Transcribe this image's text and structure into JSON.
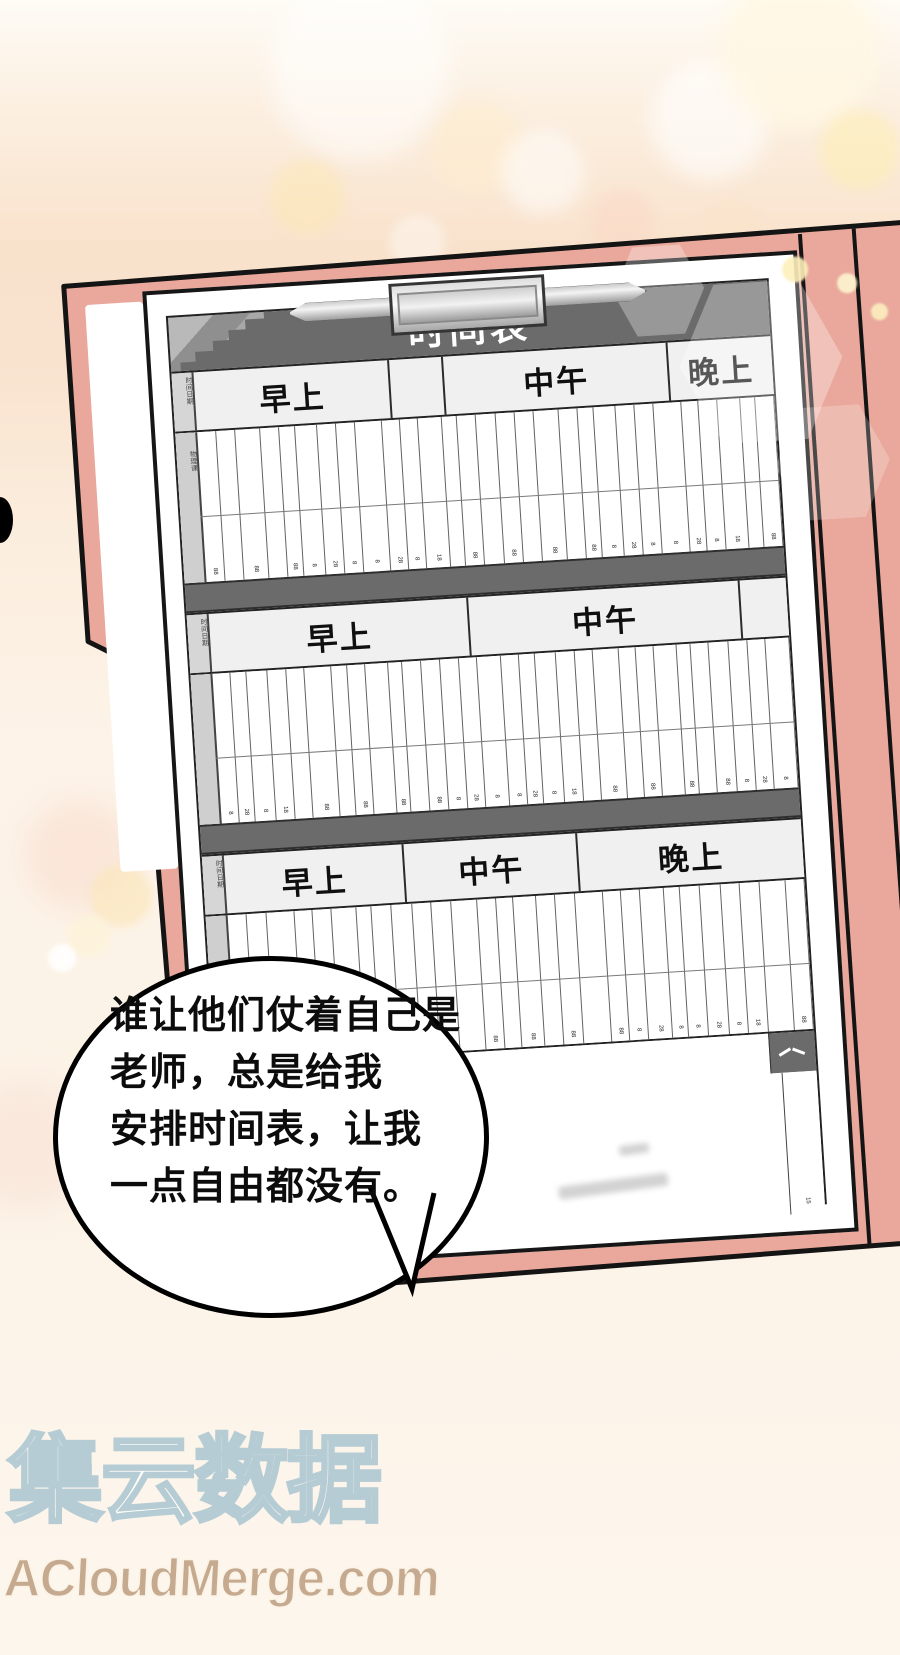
{
  "bubble": {
    "lines": [
      "谁让他们仗着自己是",
      "老师，总是给我",
      "安排时间表，让我",
      "一点自由都没有。"
    ]
  },
  "schedule": {
    "title": "时间表",
    "side_label": "时间日期",
    "side_label2": "物理课",
    "sections": [
      {
        "headers": [
          {
            "label": "早上",
            "flex": 34
          },
          {
            "label": "",
            "flex": 9
          },
          {
            "label": "中午",
            "flex": 39
          },
          {
            "label": "晚上",
            "flex": 18
          }
        ],
        "columns": 29
      },
      {
        "headers": [
          {
            "label": "早上",
            "flex": 45
          },
          {
            "label": "中午",
            "flex": 47
          },
          {
            "label": "",
            "flex": 8
          }
        ],
        "columns": 30
      },
      {
        "headers": [
          {
            "label": "早上",
            "flex": 31
          },
          {
            "label": "中午",
            "flex": 30
          },
          {
            "label": "晚上",
            "flex": 39
          }
        ],
        "columns": 28
      }
    ],
    "tick_cycle": [
      "88",
      "8",
      "",
      "28",
      "88",
      "8",
      "",
      "18",
      "88",
      "",
      "8",
      "88",
      "28",
      "",
      "8"
    ],
    "s4": {
      "grid_ticks": [
        "8",
        "8",
        "88",
        "8"
      ],
      "footer_tick": "15"
    }
  },
  "watermark": {
    "cn": "集云数据",
    "en": "ACloudMerge.com"
  },
  "colors": {
    "folder_pink": "#e9a89b",
    "band_gray": "#6b6b6b",
    "paper_white": "#ffffff",
    "outline_black": "#141414",
    "watermark_cn_outline": "#b6ccd4",
    "watermark_en_tan": "#c5aa8f",
    "bubble_text": "#0c0c0c"
  }
}
